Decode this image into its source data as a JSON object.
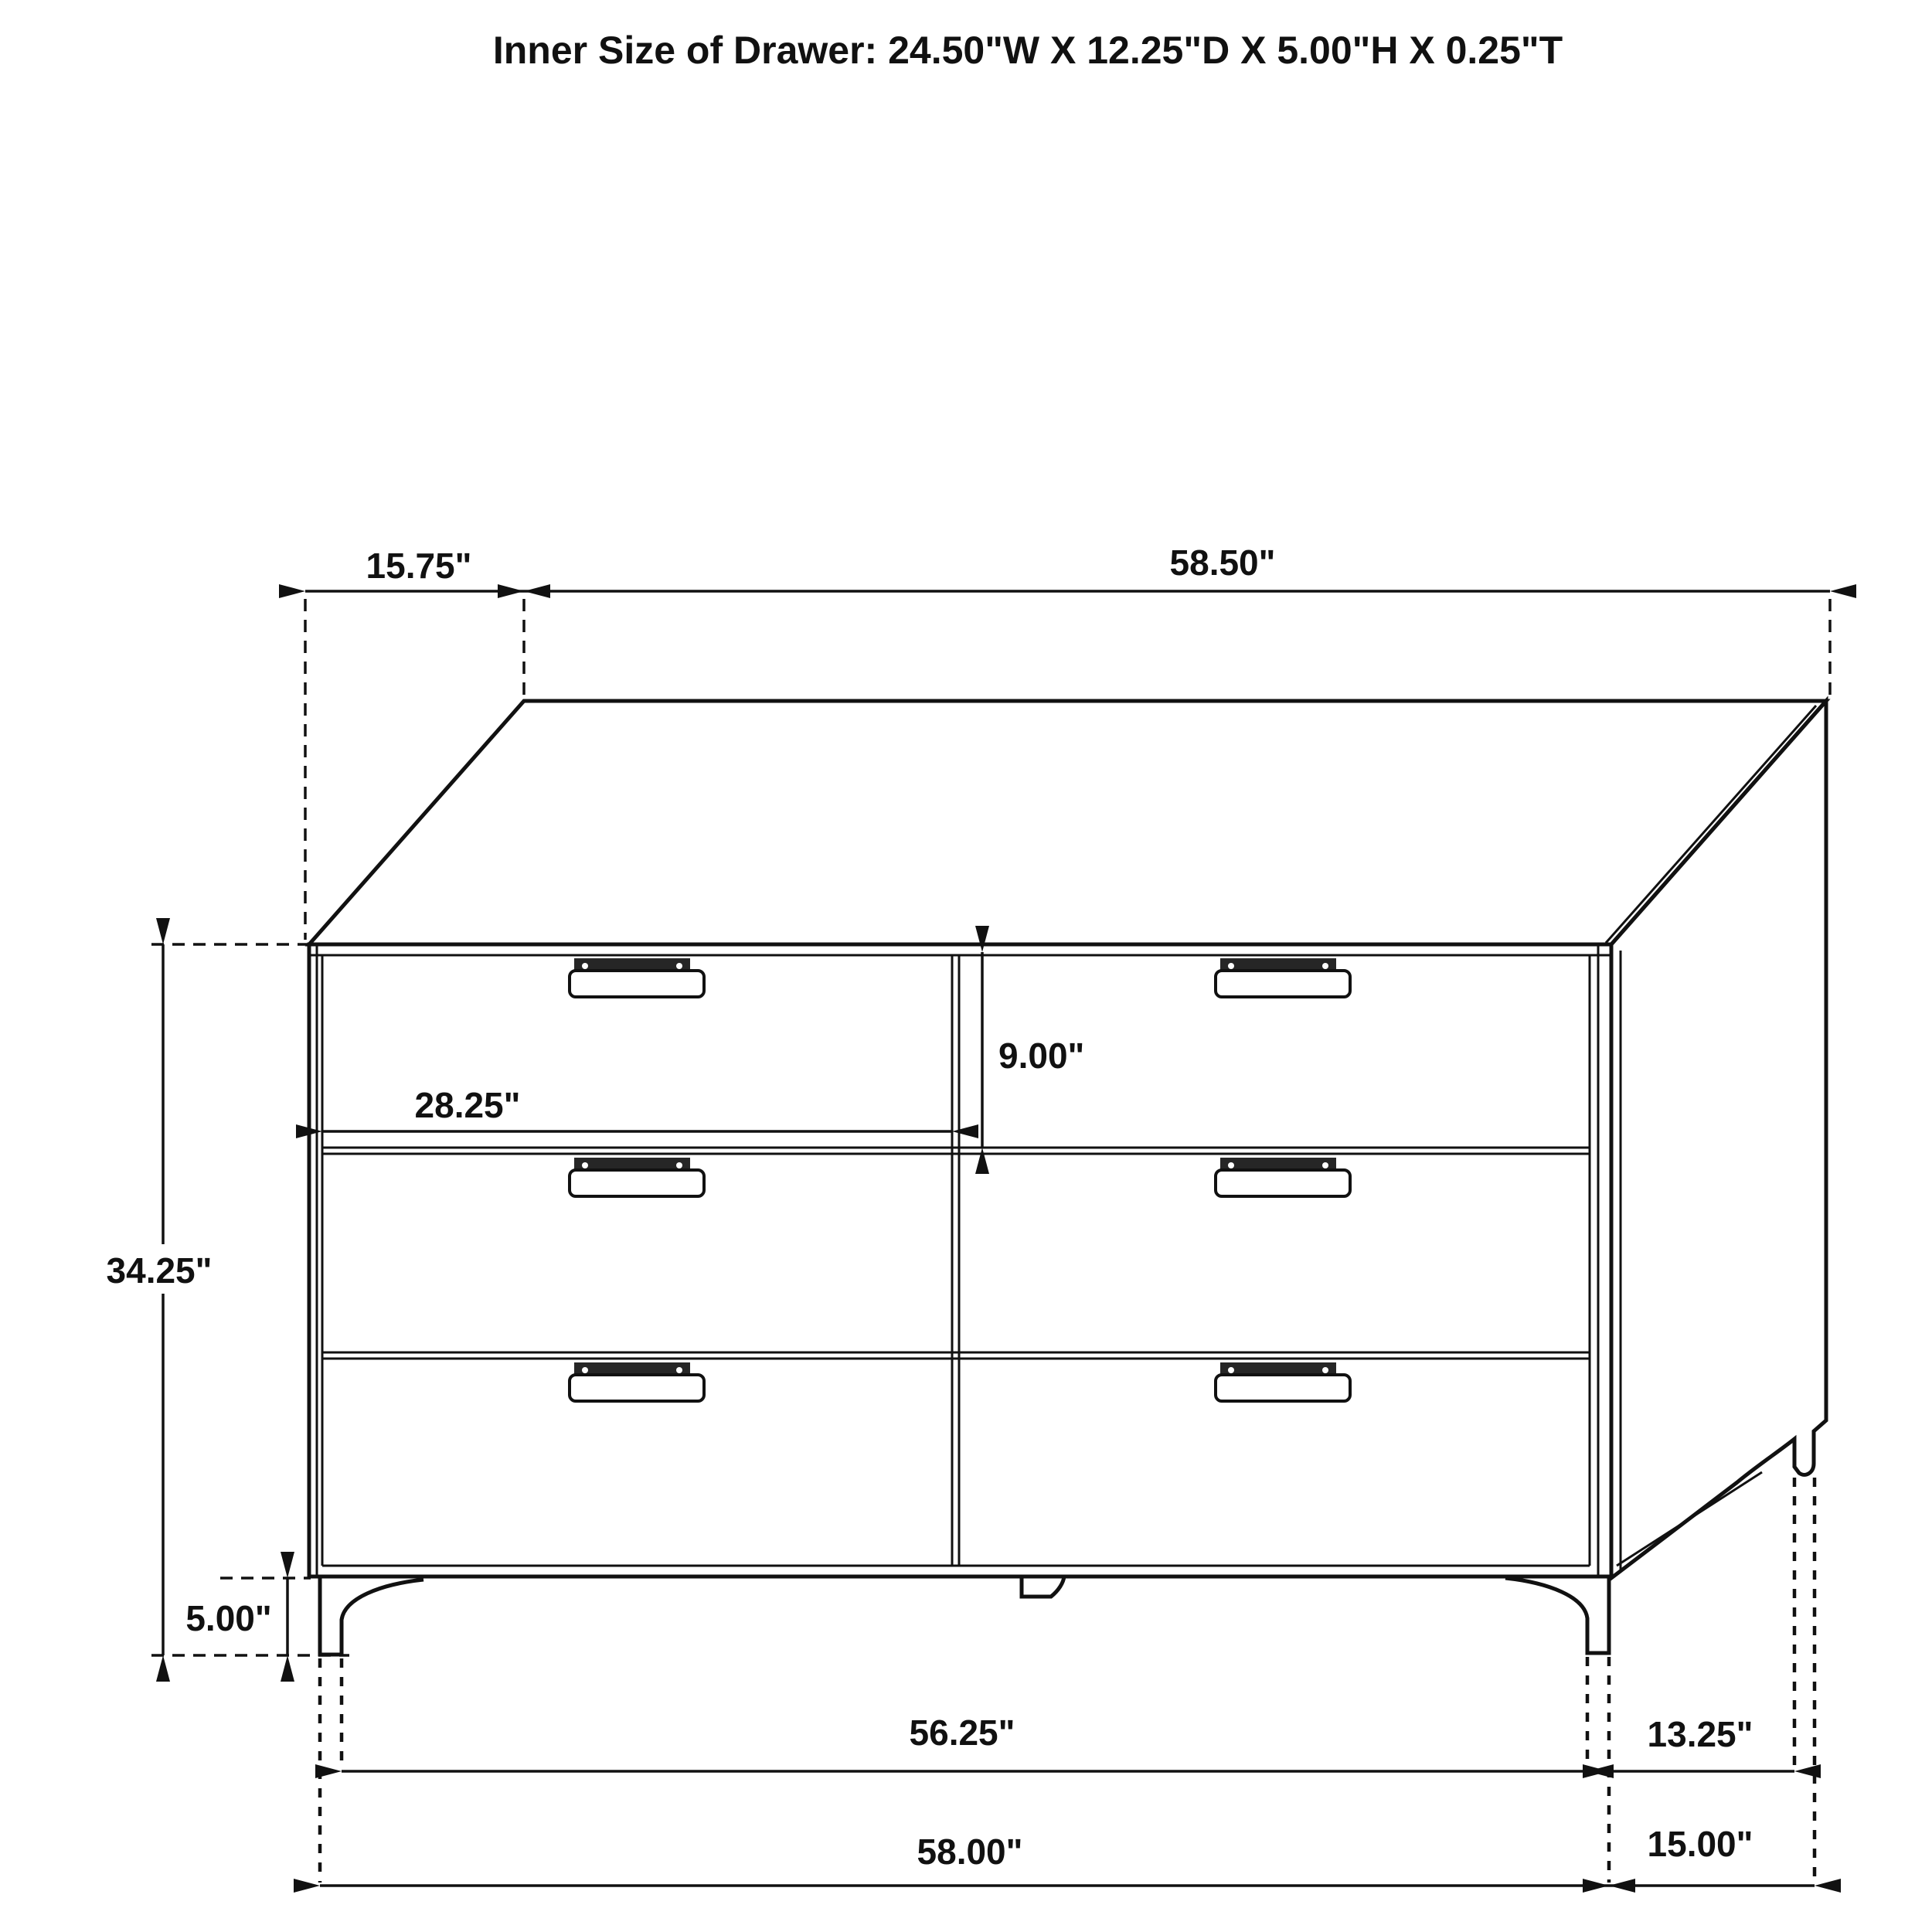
{
  "title": "Inner Size of Drawer: 24.50\"W X 12.25\"D X 5.00\"H X 0.25\"T",
  "colors": {
    "line": "#111111",
    "background": "#ffffff",
    "handle_slot": "#262626"
  },
  "dimensions": {
    "top_depth": "15.75\"",
    "top_width": "58.50\"",
    "overall_height": "34.25\"",
    "leg_height": "5.00\"",
    "drawer_front_width": "28.25\"",
    "drawer_front_height": "9.00\"",
    "front_leg_span": "56.25\"",
    "base_width": "58.00\"",
    "side_leg_span": "13.25\"",
    "base_depth": "15.00\""
  }
}
